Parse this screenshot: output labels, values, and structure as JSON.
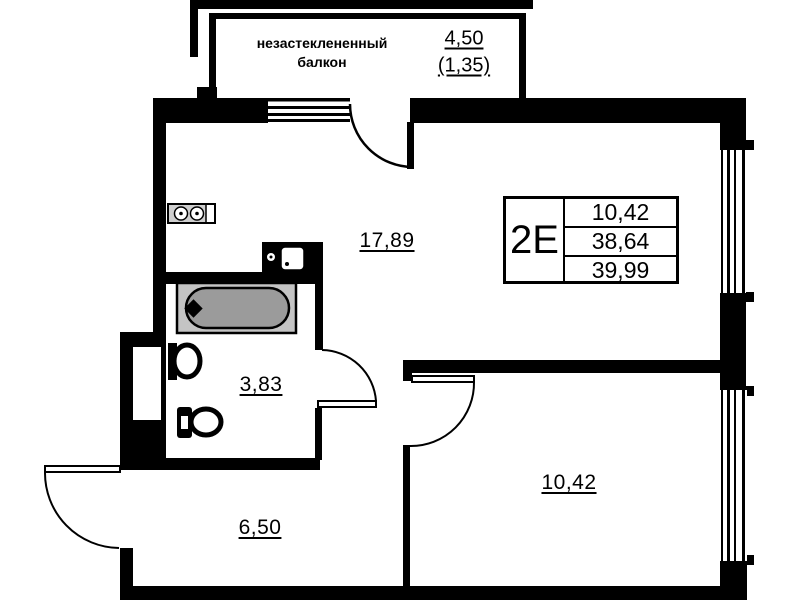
{
  "plan": {
    "balcony": {
      "label_line1": "незастеклененный",
      "label_line2": "балкон",
      "area": "4,50",
      "area_coeff": "(1,35)"
    },
    "rooms": {
      "living_area": "17,89",
      "bathroom_area": "3,83",
      "hallway_area": "6,50",
      "bedroom_area": "10,42"
    },
    "info_box": {
      "type_label": "2Е",
      "values": [
        "10,42",
        "38,64",
        "39,99"
      ]
    },
    "icons": {
      "stove": "stove-icon",
      "kitchen_sink": "kitchen-sink-icon",
      "bathtub": "bathtub-icon",
      "washbasin": "washbasin-icon",
      "toilet": "toilet-icon"
    },
    "colors": {
      "walls": "#000000",
      "background": "#ffffff",
      "tub_outer": "#c4c4c4",
      "tub_inner": "#9b9b9b"
    }
  }
}
